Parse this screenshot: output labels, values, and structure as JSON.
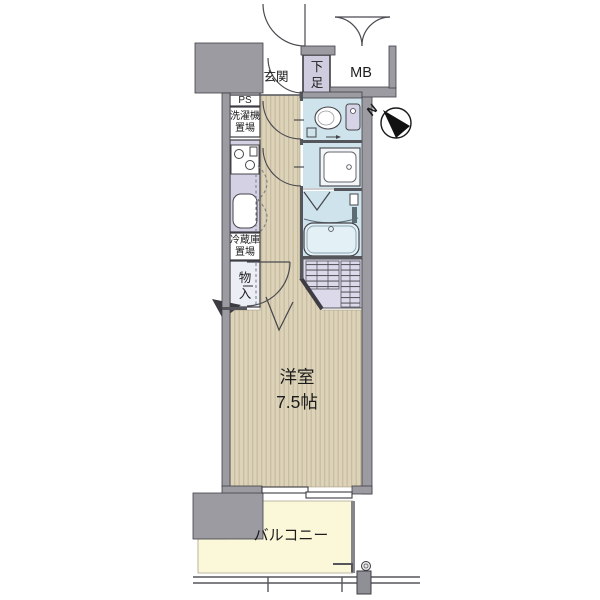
{
  "floor_plan": {
    "rooms": {
      "entrance": {
        "label": "玄関"
      },
      "shoe_cabinet": {
        "label": "下足",
        "char_top": "下",
        "char_bottom": "足"
      },
      "meter_box": {
        "label": "MB"
      },
      "pipe_space": {
        "label": "PS"
      },
      "washer_area": {
        "label": "洗濯機置場",
        "line1": "洗濯機",
        "line2": "置場"
      },
      "fridge_area": {
        "label": "冷蔵庫置場",
        "line1": "冷蔵庫",
        "line2": "置場"
      },
      "closet": {
        "label": "物入",
        "char_top": "物",
        "char_bottom": "入"
      },
      "western_room": {
        "name": "洋室",
        "size": "7.5帖"
      },
      "balcony": {
        "label": "バルコニー"
      }
    },
    "compass": {
      "north": "N"
    },
    "colors": {
      "wall": "#9b9ba1",
      "wall_dark": "#4a4a50",
      "flooring": "#ddd3b9",
      "flooring_stripe": "#c8bda2",
      "wet_room": "#cfe3ec",
      "counter_lavender": "#d4d1e4",
      "shoe_lavender": "#cfccdf",
      "balcony_yellow": "#fbf8da",
      "storage_hatch_bg": "#dcdaea"
    }
  }
}
